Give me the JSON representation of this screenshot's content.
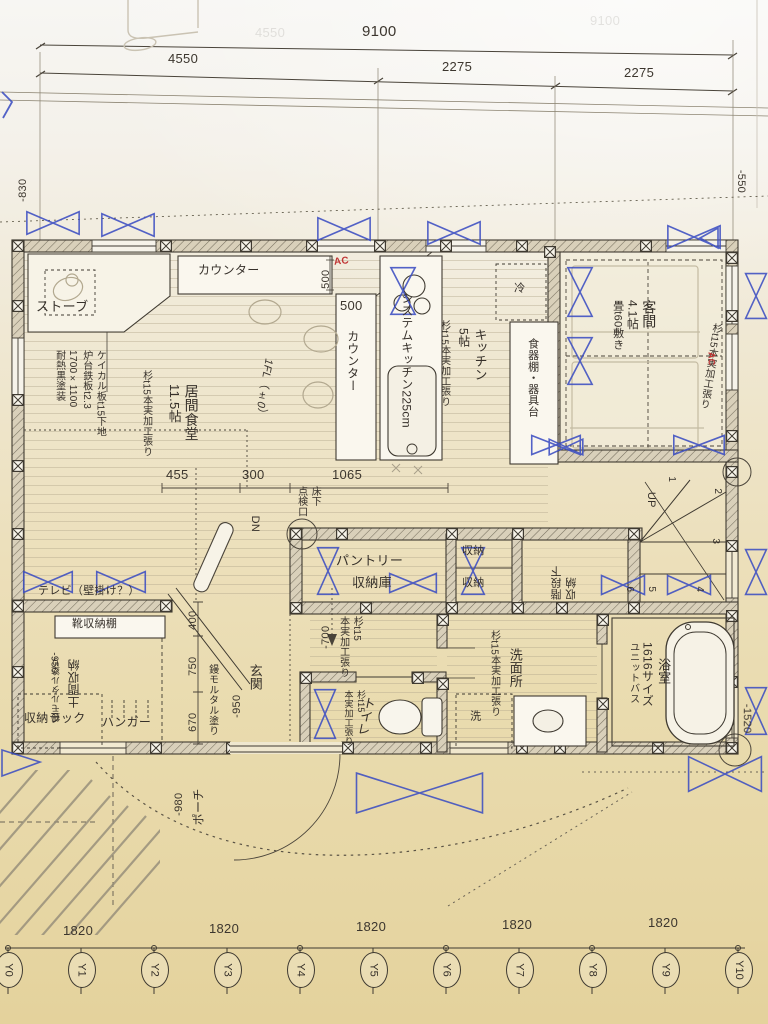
{
  "sheet": {
    "bleed_total": "9100",
    "bleed_seg": "4550"
  },
  "dims": {
    "total": "9100",
    "seg1": "4550",
    "seg2": "2275",
    "seg3": "2275",
    "left": "-830",
    "right_top": "-550",
    "right_bottom": "-1520",
    "row455": "455",
    "row300": "300",
    "row1065": "1065",
    "e400": "400",
    "e750": "750",
    "e670": "670",
    "c500a": "500",
    "c500b": "500",
    "m700": "-700",
    "m950_entrance": "-950",
    "m950_doma": "-950",
    "m980": "-980"
  },
  "grid": {
    "pitches": [
      "1820",
      "1820",
      "1820",
      "1820",
      "1820"
    ],
    "axes": [
      "Y0",
      "Y1",
      "Y2",
      "Y3",
      "Y4",
      "Y5",
      "Y6",
      "Y7",
      "Y8",
      "Y9",
      "Y10"
    ]
  },
  "rooms": {
    "living": {
      "name": "居間食堂",
      "size": "11.5帖",
      "finish": "杉t15本実加工張り",
      "level": "1FL（±0）"
    },
    "stove": {
      "label": "ストーブ",
      "notes": [
        "ケイカル板t15下地",
        "炉台鉄板t2.3",
        "1700×1100",
        "耐熱黒塗装"
      ]
    },
    "counter": {
      "top": "カウンター",
      "side": "カウンター",
      "ac": "AC"
    },
    "kitchen": {
      "name": "キッチン",
      "size": "5帖",
      "finish": "杉t15本実加工張り",
      "unit": "システムキッチン225cm",
      "fridge": "冷",
      "cupboard": "食器棚・器具台"
    },
    "guest": {
      "name": "客間",
      "size": "4.1帖",
      "tatami": "畳t60敷き",
      "finish": "杉t15本実加工張り",
      "ac": "AC"
    },
    "pantry": {
      "l1": "パントリー",
      "l2": "収納庫"
    },
    "storage": {
      "a": "収納",
      "b": "収納",
      "under1": "階段下",
      "under2": "収納"
    },
    "stairs": {
      "up": "UP",
      "n": [
        "1",
        "2",
        "3",
        "4",
        "5",
        "6"
      ]
    },
    "hall": {
      "dn": "DN",
      "insp1": "床下",
      "insp2": "点検口",
      "finish1": "杉t15",
      "finish2": "本実加工張り"
    },
    "toilet": {
      "name": "トイレ",
      "finish1": "杉t15",
      "finish2": "本実加工張り"
    },
    "wash": {
      "name": "洗面所",
      "finish": "杉t15本実加工張り",
      "washer": "洗"
    },
    "bath": {
      "name": "浴室",
      "size": "1616サイズ",
      "type": "ユニットバス"
    },
    "entrance": {
      "name": "玄関",
      "finish": "鏝モルタル塗り"
    },
    "doma": {
      "name": "土間収納",
      "finish": "鏝モルタル塗り",
      "shoe": "靴収納棚",
      "tv": "テレビ（壁掛け？）",
      "rack": "収納ラック",
      "hanger": "ハンガー"
    },
    "porch": {
      "name": "ポーチ"
    }
  },
  "colors": {
    "pen_blue": "#3c4ec2",
    "ac_red": "#c03535",
    "ink": "#3f3a31",
    "paper_top": "#f6f4f0",
    "paper_bottom": "#e6d6a2"
  }
}
